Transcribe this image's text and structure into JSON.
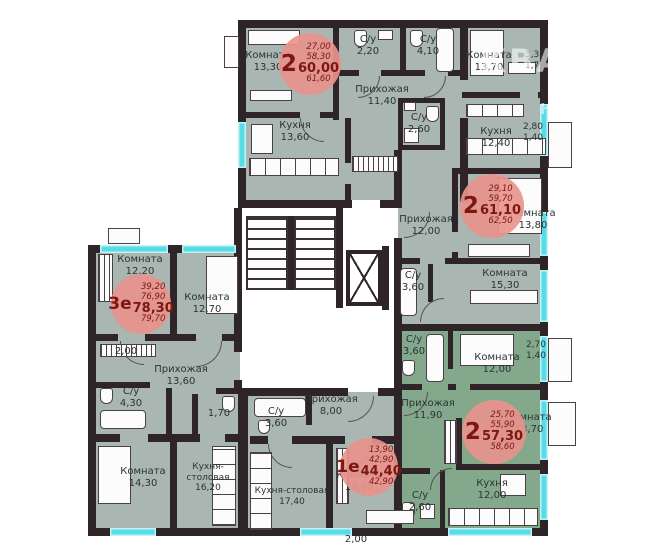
{
  "watermark": {
    "brand": "КВАРТАЛ",
    "sub": "НЕДВИЖИМОСТЬ",
    "mark": "К"
  },
  "colors": {
    "room_fill": "#a9b6b2",
    "highlight_fill": "#84a88b",
    "wall": "#2f2529",
    "window": "#55dce6",
    "badge_fill": "#e8948c",
    "badge_text": "#7c1712",
    "label_text": "#2c3335"
  },
  "badges": [
    {
      "num": "2",
      "line1": "27,00",
      "line2": "58,30",
      "total": "60,00",
      "line4": "61,60"
    },
    {
      "num": "2",
      "line1": "29,10",
      "line2": "59,70",
      "total": "61,10",
      "line4": "62,50"
    },
    {
      "num": "3е",
      "line1": "39,20",
      "line2": "76,90",
      "total": "78,30",
      "line4": "79,70"
    },
    {
      "num": "1е",
      "line1": "13,90",
      "line2": "42,90",
      "total": "44,40",
      "line4": "42,90"
    },
    {
      "num": "2",
      "line1": "25,70",
      "line2": "55,90",
      "total": "57,30",
      "line4": "58,60"
    }
  ],
  "rooms": [
    {
      "label": "Комната",
      "area": "13,30"
    },
    {
      "label": "С/у",
      "area": "2,20"
    },
    {
      "label": "С/у",
      "area": "4,10"
    },
    {
      "label": "Прихожая",
      "area": "11,40"
    },
    {
      "label": "Кухня",
      "area": "13,60"
    },
    {
      "label": "Комната",
      "area": "13,70"
    },
    {
      "label": "3,30",
      "area": "1,70"
    },
    {
      "label": "С/у",
      "area": "2,60"
    },
    {
      "label": "Кухня",
      "area": "12,40"
    },
    {
      "label": "2,80",
      "area": "1,40"
    },
    {
      "label": "Прихожая",
      "area": "12,00"
    },
    {
      "label": "Комната",
      "area": "13,80"
    },
    {
      "label": "С/у",
      "area": "3,60"
    },
    {
      "label": "Комната",
      "area": "15,30"
    },
    {
      "label": "Комната",
      "area": "12,20"
    },
    {
      "label": "Комната",
      "area": "12,70"
    },
    {
      "label": "2,00",
      "area": ""
    },
    {
      "label": "Прихожая",
      "area": "13,60"
    },
    {
      "label": "С/у",
      "area": "4,30"
    },
    {
      "label": "1,70",
      "area": ""
    },
    {
      "label": "Комната",
      "area": "14,30"
    },
    {
      "label": "Кухня-столовая",
      "area": "16,20"
    },
    {
      "label": "С/у",
      "area": "3,60"
    },
    {
      "label": "Прихожая",
      "area": "8,00"
    },
    {
      "label": "Кухня-столовая",
      "area": "17,40"
    },
    {
      "label": "Комната",
      "area": "13,90"
    },
    {
      "label": "С/у",
      "area": "3,60"
    },
    {
      "label": "Комната",
      "area": "12,00"
    },
    {
      "label": "2,70",
      "area": "1,40"
    },
    {
      "label": "Прихожая",
      "area": "11,90"
    },
    {
      "label": "Комната",
      "area": "13,70"
    },
    {
      "label": "С/у",
      "area": "2,60"
    },
    {
      "label": "Кухня",
      "area": "12,00"
    },
    {
      "label": "2,00",
      "area": ""
    }
  ]
}
